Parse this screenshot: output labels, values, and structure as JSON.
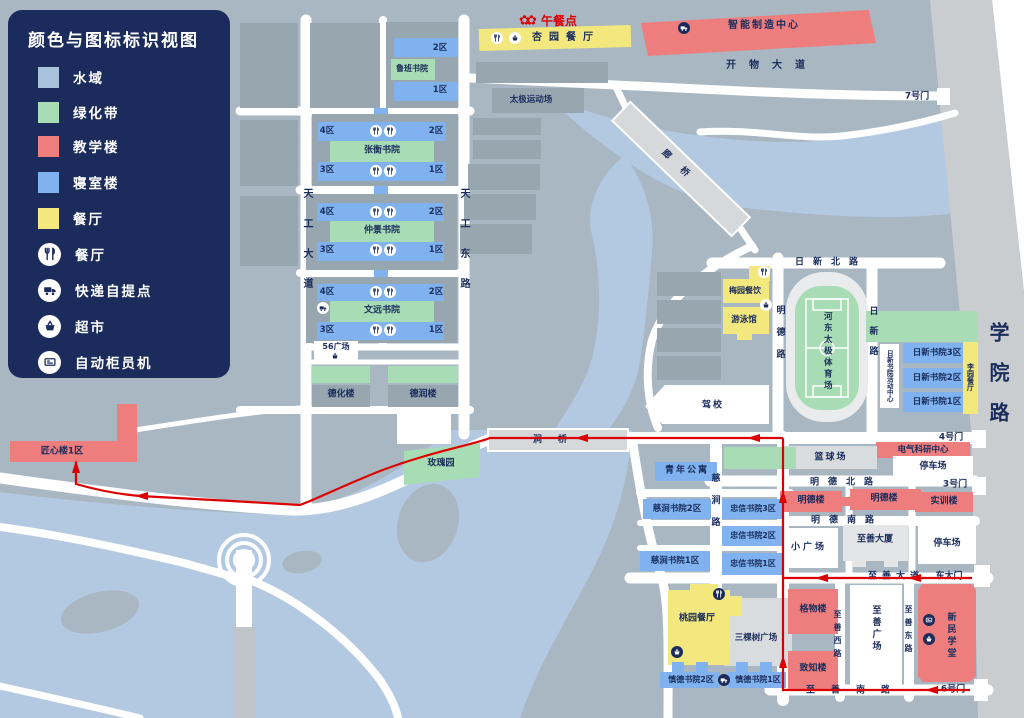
{
  "legend": {
    "title": "颜色与图标标识视图",
    "items": [
      {
        "label": "水域",
        "type": "swatch",
        "color": "#a9c2dc"
      },
      {
        "label": "绿化带",
        "type": "swatch",
        "color": "#a8dcb4"
      },
      {
        "label": "教学楼",
        "type": "swatch",
        "color": "#ee7e7e"
      },
      {
        "label": "寝室楼",
        "type": "swatch",
        "color": "#7fb2ee"
      },
      {
        "label": "餐厅",
        "type": "swatch",
        "color": "#f2e87d"
      },
      {
        "label": "餐厅",
        "type": "icon",
        "icon": "restaurant-icon"
      },
      {
        "label": "快递自提点",
        "type": "icon",
        "icon": "parcel-pickup-icon"
      },
      {
        "label": "超市",
        "type": "icon",
        "icon": "supermarket-icon"
      },
      {
        "label": "自动柜员机",
        "type": "icon",
        "icon": "atm-icon"
      }
    ]
  },
  "colors": {
    "ground": "#a9b7c3",
    "water": "#b3c9e2",
    "green": "#a8dcb4",
    "dorm": "#7fb2ee",
    "teaching": "#ee7e7e",
    "dining": "#f2e87d",
    "route": "#dd0000",
    "legend_bg": "#1b2c5c",
    "text": "#1a2d5c",
    "campus_road": "#c9cdcf"
  },
  "route": {
    "color": "#dd0000"
  },
  "t": {
    "z1": "1区",
    "z2": "2区",
    "z3": "3区",
    "z4": "4区",
    "luban": "鲁班书院",
    "zhangheng": "张衡书院",
    "zhongjing": "仲景书院",
    "wenyuan": "文远书院",
    "plaza56": "56广场",
    "dehua": "德化楼",
    "derun": "德润楼",
    "xingyuan": "杏园餐厅",
    "lunch": "午餐点",
    "zhineng": "智能制造中心",
    "taiji": "太极运动场",
    "langqiao": "廊桥",
    "gate7": "7号门",
    "kaiwu": "开物大道",
    "xueyuan": "学院路",
    "tiangong_w": "天工大道",
    "tiangong_e": "天工东路",
    "jiangxin": "匠心楼1区",
    "meigui": "玫瑰园",
    "jianqiao": "涧桥",
    "rixin_n": "日新北路",
    "meiyuan": "梅园餐饮",
    "youyong": "游泳馆",
    "mingde_rd": "明德路",
    "stadium": "河东太极体育场",
    "rixin_rd": "日新路",
    "rixin_ac": "日新书院活动中心",
    "rixin3": "日新书院3区",
    "rixin2": "日新书院2区",
    "rixin1": "日新书院1区",
    "liyuan": "李园餐厅",
    "jiaxiao": "驾校",
    "gate4": "4号门",
    "dianqi": "电气科研中心",
    "parking": "停车场",
    "gate3": "3号门",
    "lanqiu": "篮球场",
    "mingde_n": "明德北路",
    "mingdelou": "明德楼",
    "shixun": "实训楼",
    "mingde_s": "明德南路",
    "xiaogc": "小广场",
    "zhishan_tw": "至善大厦",
    "zhishan_av": "至善大道",
    "dongdamen": "东大门",
    "qingnian": "青年公寓",
    "cijian2": "慈涧书院2区",
    "cijian1": "慈涧书院1区",
    "cijian_rd": "慈涧路",
    "zhongxin3": "忠信书院3区",
    "zhongxin2": "忠信书院2区",
    "zhongxin1": "忠信书院1区",
    "taoyuan": "桃园餐厅",
    "sankeshu": "三棵树广场",
    "shende2": "慎德书院2区",
    "shende1": "慎德书院1区",
    "gewu": "格物楼",
    "zhizhi": "致知楼",
    "zhishan_w": "至善西路",
    "zhishan_gc": "至善广场",
    "zhishan_e": "至善东路",
    "xinmin": "新民学堂",
    "zhishan_s": "至善南路",
    "gate6": "6号门"
  }
}
